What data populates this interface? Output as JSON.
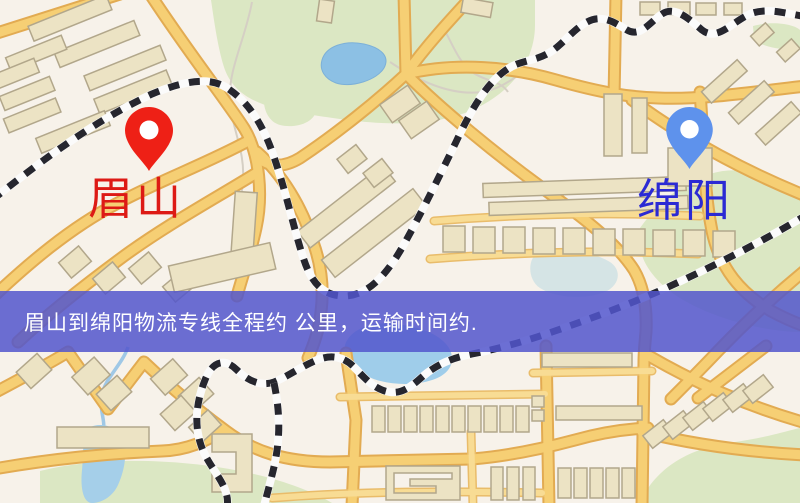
{
  "map": {
    "markers": [
      {
        "id": "meishan",
        "label": "眉山",
        "pin_color": "#ee2016",
        "label_color": "#dd1a15",
        "icon": "location-pin-icon"
      },
      {
        "id": "mianyang",
        "label": "绵阳",
        "pin_color": "#5e92ec",
        "label_color": "#2b2ad4",
        "icon": "location-pin-icon"
      }
    ],
    "banner": {
      "text": "眉山到绵阳物流专线全程约 公里，运输时间约.",
      "background_color": "#5256cd",
      "text_color": "#ffffff"
    },
    "palette": {
      "land": "#f7f2ea",
      "park": "#dbe7c3",
      "water": "#8cc0e4",
      "road": "#f6cf74",
      "road_casing": "#e2ab52",
      "railway": "#26262e",
      "building": "#ece3c4"
    }
  }
}
